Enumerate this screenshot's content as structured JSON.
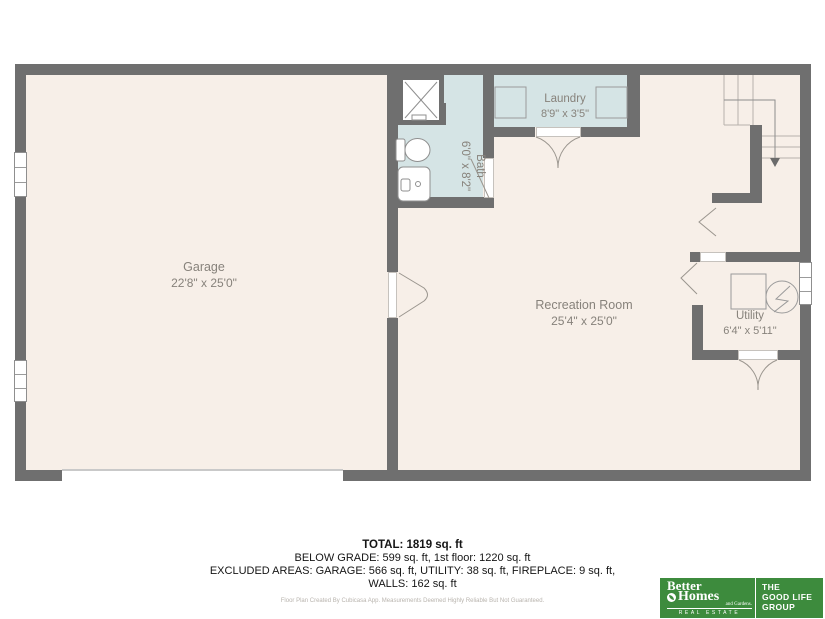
{
  "rooms": {
    "garage": {
      "name": "Garage",
      "dims": "22'8\" x 25'0\""
    },
    "bath": {
      "name": "Bath",
      "dims": "6'0\" x 8'2\""
    },
    "laundry": {
      "name": "Laundry",
      "dims": "8'9\" x 3'5\""
    },
    "recreation": {
      "name": "Recreation Room",
      "dims": "25'4\" x 25'0\""
    },
    "utility": {
      "name": "Utility",
      "dims": "6'4\" x 5'11\""
    }
  },
  "summary": {
    "total": "TOTAL: 1819 sq. ft",
    "line2": "BELOW GRADE: 599 sq. ft, 1st floor: 1220 sq. ft",
    "line3": "EXCLUDED AREAS: GARAGE: 566 sq. ft, UTILITY: 38 sq. ft, FIREPLACE: 9 sq. ft,",
    "line4": "WALLS: 162 sq. ft",
    "disclaimer": "Floor Plan Created By Cubicasa App. Measurements Deemed Highly Reliable But Not Guaranteed."
  },
  "branding": {
    "brand_line1": "Better",
    "brand_line2": "Homes",
    "brand_sub": "and Gardens.",
    "brand_band": "REAL ESTATE",
    "group_line1": "THE",
    "group_line2": "GOOD LIFE",
    "group_line3": "GROUP"
  },
  "colors": {
    "wall": "#6f6f6f",
    "floor": "#f7efe8",
    "wet": "#d5e4e5",
    "brand_green": "#3d8b3d",
    "label_text": "#87827b"
  }
}
